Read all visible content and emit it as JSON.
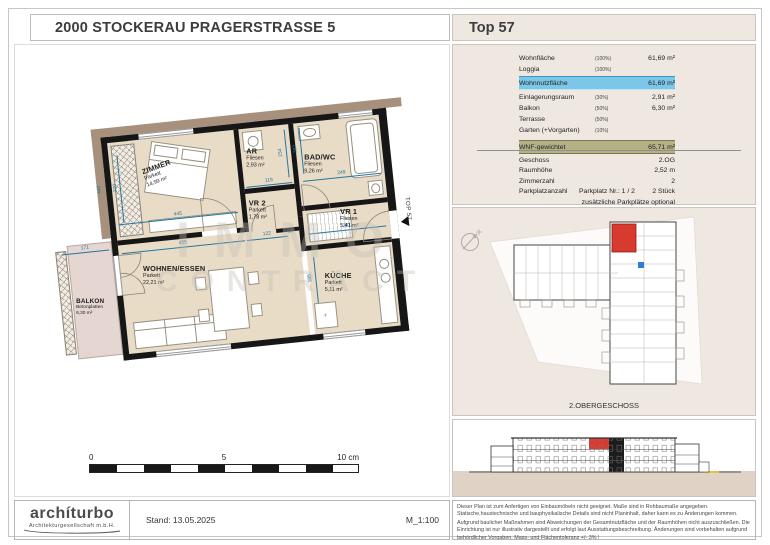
{
  "header": {
    "title": "2000 STOCKERAU PRAGERSTRASSE 5",
    "unit_label": "Top 57"
  },
  "area_table": {
    "rows": [
      {
        "label": "Wohnfläche",
        "pct": "(100%)",
        "value": "61,69 m²"
      },
      {
        "label": "Loggia",
        "pct": "(100%)",
        "value": ""
      },
      {
        "label": "Wohnnutzfläche",
        "pct": "",
        "value": "61,69 m²"
      },
      {
        "label": "Einlagerungsraum",
        "pct": "(30%)",
        "value": "2,91 m²"
      },
      {
        "label": "Balkon",
        "pct": "(50%)",
        "value": "6,30 m²"
      },
      {
        "label": "Terrasse",
        "pct": "(50%)",
        "value": ""
      },
      {
        "label": "Garten (+Vorgarten)",
        "pct": "(10%)",
        "value": ""
      },
      {
        "label": "WNF-gewichtet",
        "pct": "",
        "value": "65,71 m²"
      }
    ]
  },
  "detail_table": {
    "rows": [
      {
        "label": "Geschoss",
        "mid": "",
        "value": "2.OG"
      },
      {
        "label": "Raumhöhe",
        "mid": "",
        "value": "2,52 m"
      },
      {
        "label": "Zimmerzahl",
        "mid": "",
        "value": "2"
      },
      {
        "label": "Parkplatzanzahl",
        "mid": "Parkplatz Nr.: 1 / 2",
        "value": "2 Stück"
      },
      {
        "label": "",
        "mid": "",
        "value": "zusätzliche Parkplätze optional"
      }
    ]
  },
  "floor_plan": {
    "rooms": [
      {
        "name": "ZIMMER",
        "finish": "Parkett",
        "area": "14,99 m²"
      },
      {
        "name": "AR",
        "finish": "Fliesen",
        "area": "2,93 m²"
      },
      {
        "name": "BAD/WC",
        "finish": "Fliesen",
        "area": "9,26 m²"
      },
      {
        "name": "VR 2",
        "finish": "Parkett",
        "area": "1,78 m²"
      },
      {
        "name": "VR 1",
        "finish": "Fliesen",
        "area": "5,41 m²"
      },
      {
        "name": "WOHNEN/ESSEN",
        "finish": "Parkett",
        "area": "22,21 m²"
      },
      {
        "name": "KÜCHE",
        "finish": "Parkett",
        "area": "5,11 m²"
      },
      {
        "name": "BALKON",
        "finish": "Betonplatten",
        "area": "6,30 m²"
      }
    ],
    "dims": {
      "zimmer_w": "445",
      "zimmer_h": "300",
      "ar_w": "119",
      "ar_h": "234",
      "bad_w": "249",
      "bad_h": "387",
      "wohnen_w": "455",
      "corr1": "122",
      "corr2": "10",
      "vr1_w": "261",
      "balkon_w": "171",
      "left_h": "440",
      "kueche_h": "185"
    },
    "entrance_label": "TOP 57",
    "watermark_line1": "IMMO",
    "watermark_line2": "CONTRACT"
  },
  "scale_bar": {
    "t0": "0",
    "t5": "5",
    "t10": "10 cm"
  },
  "site_plan": {
    "caption": "2.OBERGESCHOSS"
  },
  "footer": {
    "logo_text": "archíturbo",
    "logo_sub": "Architekturgesellschaft m.b.H.",
    "stand": "Stand: 13.05.2025",
    "scale_label": "M_1:100"
  },
  "disclaimer": {
    "p1": "Dieser Plan ist zum Anfertigen von Einbaumöbeln nicht geeignet. Maße sind in Rohbaumaße angegeben. Statische,haustechnische und bauphysikalische Details sind nicht Planinhalt, daher kann es zu Änderungen kommen.",
    "p2": "Aufgrund baulicher Maßnahmen sind Abweichungen der Gesamtnutzfläche und der Raumhöhen nicht auszuschließen. Die Einrichtung ist nur illustrativ dargestellt und erfolgt laut Ausstattungsbeschreibung. Änderungen sind vorbehalten aufgrund behördlicher Vorgaben. Mass- und Flächentoleranz +/- 3% !"
  },
  "colors": {
    "panel_beige": "#EFE8E1",
    "highlight_blue": "#7CC7E8",
    "highlight_olive": "#B5B187",
    "floor_tan": "#E9DCC6",
    "balcony_pink": "#E5D6D2",
    "wall_black": "#161616",
    "adjacent_tan": "#A8917C",
    "dim_teal": "#2576A0",
    "unit_red": "#D93A30",
    "marker_blue": "#2E7CD6"
  }
}
